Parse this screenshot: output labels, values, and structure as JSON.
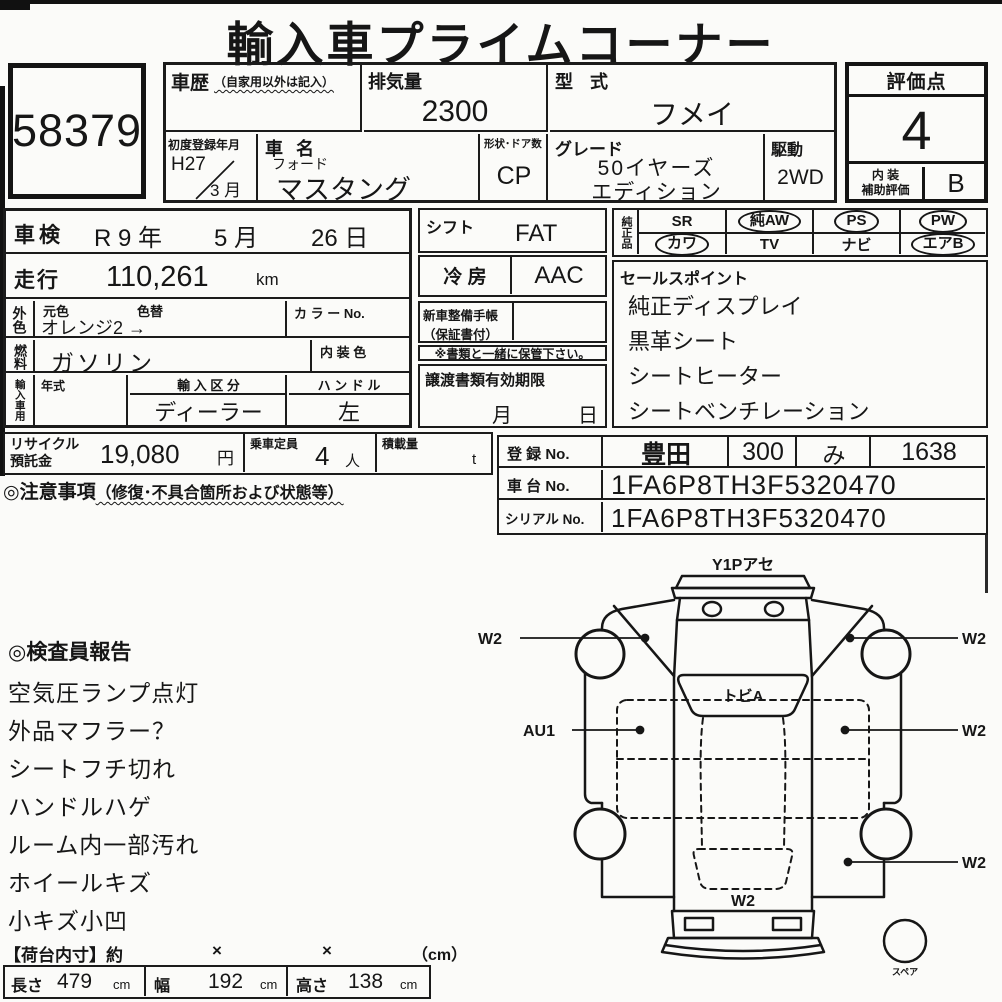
{
  "title": "輸入車プライムコーナー",
  "lot_no": "58379",
  "vehicle": {
    "history_label": "車歴",
    "history_note": "（自家用以外は記入）",
    "displacement_label": "排気量",
    "displacement": "2300",
    "model_code_label": "型 式",
    "model_code": "フメイ",
    "first_reg_label": "初度登録年月",
    "first_reg_year": "H27",
    "first_reg_sep": "／",
    "first_reg_month": "3 月",
    "name_label": "車 名",
    "maker": "フォード",
    "name": "マスタング",
    "body_doors_label": "形状･ドア数",
    "body_doors": "CP",
    "grade_label": "グレード",
    "grade_line1": "50イヤーズ",
    "grade_line2": "エディション",
    "drive_label": "駆動",
    "drive": "2WD"
  },
  "score": {
    "label": "評価点",
    "value": "4",
    "interior_label_1": "内 装",
    "interior_label_2": "補助評価",
    "interior_value": "B"
  },
  "inspection": {
    "label": "車検",
    "era": "R 9 年",
    "month": "5 月",
    "day": "26 日"
  },
  "mileage": {
    "label": "走行",
    "value": "110,261",
    "unit": "km"
  },
  "ext_color": {
    "label": "外色",
    "orig_label": "元色",
    "change_label": "色替",
    "value": "オレンジ2 →",
    "color_no_label": "カ ラ ー No."
  },
  "fuel": {
    "label": "燃料",
    "value": "ガソリン",
    "interior_color_label": "内 装 色"
  },
  "import_use": {
    "label": "輸入車用",
    "year_label": "年式",
    "class_label": "輸 入 区 分",
    "class_value": "ディーラー",
    "handle_label": "ハ ン ド ル",
    "handle_value": "左"
  },
  "shift": {
    "label": "シフト",
    "value": "FAT"
  },
  "ac": {
    "label": "冷 房",
    "value": "AAC"
  },
  "service_book": {
    "line1": "新車整備手帳",
    "line2": "（保証書付）",
    "note": "※書類と一緒に保管下さい。"
  },
  "transfer_docs": {
    "label": "譲渡書類有効期限",
    "month": "月",
    "day": "日"
  },
  "equipment": {
    "label": "純正品",
    "items": [
      {
        "label": "SR",
        "circled": false
      },
      {
        "label": "純AW",
        "circled": true
      },
      {
        "label": "PS",
        "circled": true
      },
      {
        "label": "PW",
        "circled": true
      },
      {
        "label": "カワ",
        "circled": true
      },
      {
        "label": "TV",
        "circled": false
      },
      {
        "label": "ナビ",
        "circled": false
      },
      {
        "label": "エアB",
        "circled": true
      }
    ]
  },
  "sales_points": {
    "label": "セールスポイント",
    "items": [
      "純正ディスプレイ",
      "黒革シート",
      "シートヒーター",
      "シートベンチレーション"
    ]
  },
  "recycle": {
    "label_1": "リサイクル",
    "label_2": "預託金",
    "value": "19,080",
    "unit": "円"
  },
  "capacity": {
    "label": "乗車定員",
    "value": "4",
    "unit": "人"
  },
  "load": {
    "label": "積載量",
    "unit": "t"
  },
  "caution": {
    "label": "◎注意事項",
    "note": "（修復･不具合箇所および状態等）"
  },
  "registration": {
    "reg_label": "登 録 No.",
    "reg_area": "豊田",
    "reg_class": "300",
    "reg_kana": "み",
    "reg_number": "1638",
    "chassis_label": "車 台 No.",
    "chassis_no": "1FA6P8TH3F5320470",
    "serial_label": "シリアル No.",
    "serial_no": "1FA6P8TH3F5320470"
  },
  "inspector_report": {
    "title": "◎検査員報告",
    "items": [
      "空気圧ランプ点灯",
      "外品マフラー？",
      "シートフチ切れ",
      "ハンドルハゲ",
      "ルーム内一部汚れ",
      "ホイールキズ",
      "小キズ小凹"
    ]
  },
  "cargo": {
    "header": "【荷台内寸】約",
    "x1": "×",
    "x2": "×",
    "unit": "（cm）",
    "length_label": "長さ",
    "length": "479",
    "length_unit": "cm",
    "width_label": "幅",
    "width": "192",
    "width_unit": "cm",
    "height_label": "高さ",
    "height": "138",
    "height_unit": "cm"
  },
  "diagram": {
    "front_bumper": "Y1Pアセ",
    "windshield": "トビA",
    "front_left_wheel": "W2",
    "front_right_wheel": "W2",
    "left_door": "AU1",
    "right_door": "W2",
    "rear_right_wheel": "W2",
    "trunk": "W2",
    "spare": "スペア"
  },
  "colors": {
    "ink": "#1b1b1b",
    "paper": "#fbfbf9"
  }
}
